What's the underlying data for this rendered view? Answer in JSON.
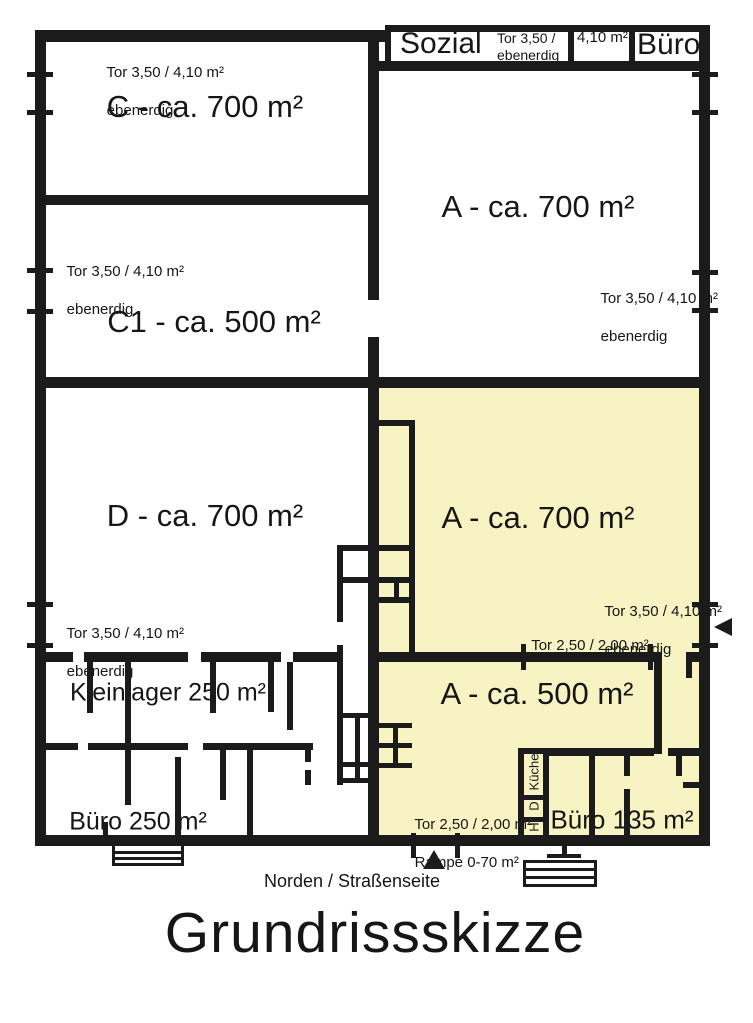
{
  "title": "Grundrissskizze",
  "compass": {
    "label": "Norden / Straßenseite"
  },
  "colors": {
    "wall": "#1b1b1b",
    "highlight_fill": "#f8f3c3",
    "background": "#ffffff"
  },
  "top_strip": {
    "sozial_label": "Sozial",
    "tor_line1": "Tor 3,50 /",
    "tor_line2": "ebenerdig",
    "tor_area": "4,10 m²",
    "buero_label": "Büro"
  },
  "rooms": {
    "c": {
      "label": "C - ca. 700 m²",
      "note1": "Tor 3,50 / 4,10 m²",
      "note2": "ebenerdig"
    },
    "c1": {
      "label": "C1 - ca. 500 m²",
      "note1": "Tor 3,50 / 4,10 m²",
      "note2": "ebenerdig"
    },
    "d": {
      "label": "D - ca. 700 m²",
      "note1": "Tor 3,50 / 4,10 m²",
      "note2": "ebenerdig"
    },
    "a_top": {
      "label": "A - ca. 700 m²",
      "note1": "Tor 3,50 / 4,10 m²",
      "note2": "ebenerdig"
    },
    "a_mid": {
      "label": "A - ca. 700 m²",
      "note1": "Tor 3,50 / 4,10 m²",
      "note2": "ebenerdig",
      "tor_small": "Tor 2,50 / 2,00 m²"
    },
    "a_low": {
      "label": "A - ca. 500 m²",
      "ramp_note1": "Tor 2,50 / 2,00 m²",
      "ramp_note2": "Rampe 0-70 m²"
    },
    "kleinlager": {
      "label": "Kleinlager 250 m²"
    },
    "buero250": {
      "label": "Büro 250 m²"
    },
    "buero135": {
      "label": "Büro 135 m²"
    },
    "kueche": {
      "label": "Küche",
      "cell_d": "D",
      "cell_h": "H"
    }
  }
}
